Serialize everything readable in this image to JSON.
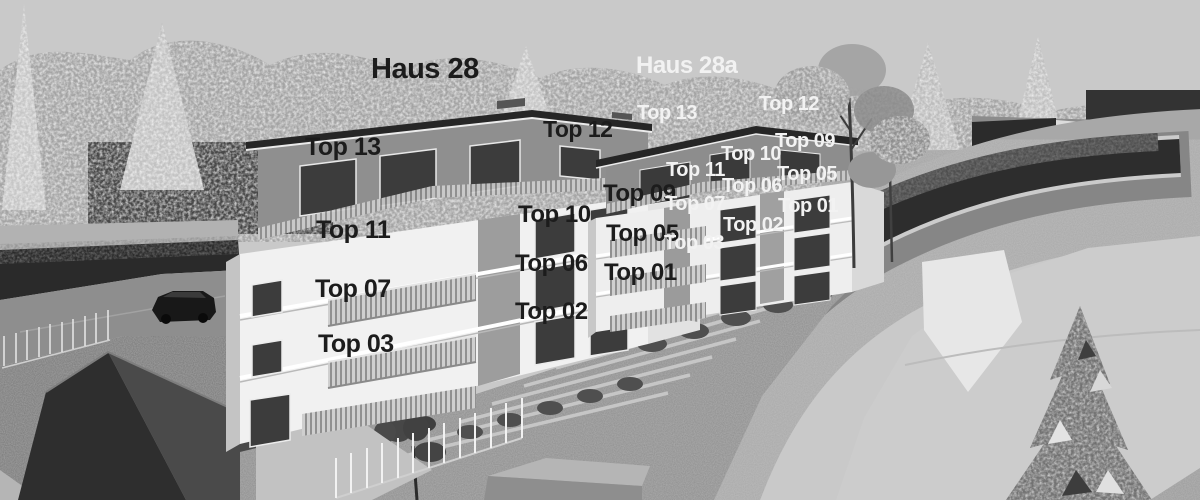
{
  "scene": {
    "kind": "architectural-rendering",
    "style": "grayscale 3D exterior visualization of two apartment buildings on a terraced slope with a curving road",
    "buildings": [
      {
        "id": "haus-28",
        "title": "Haus 28",
        "visible_units": [
          "Top 13",
          "Top 12",
          "Top 11",
          "Top 10",
          "Top 09",
          "Top 07",
          "Top 06",
          "Top 05",
          "Top 03",
          "Top 02",
          "Top 01"
        ]
      },
      {
        "id": "haus-28a",
        "title": "Haus 28a",
        "visible_units": [
          "Top 13",
          "Top 12",
          "Top 11",
          "Top 10",
          "Top 09",
          "Top 07",
          "Top 06",
          "Top 05",
          "Top 03",
          "Top 02",
          "Top 01"
        ]
      }
    ]
  },
  "annotations": {
    "building_titles": [
      {
        "building": "haus-28",
        "text": "Haus 28",
        "x": 371,
        "y": 55,
        "size": 29,
        "tone": "dark"
      },
      {
        "building": "haus-28a",
        "text": "Haus 28a",
        "x": 636,
        "y": 54,
        "size": 24,
        "tone": "light"
      }
    ],
    "unit_labels": [
      {
        "building": "haus-28",
        "text": "Top 13",
        "x": 305,
        "y": 135,
        "size": 25,
        "tone": "dark"
      },
      {
        "building": "haus-28",
        "text": "Top 12",
        "x": 543,
        "y": 118,
        "size": 23,
        "tone": "dark"
      },
      {
        "building": "haus-28",
        "text": "Top 11",
        "x": 316,
        "y": 218,
        "size": 25,
        "tone": "dark"
      },
      {
        "building": "haus-28",
        "text": "Top 10",
        "x": 518,
        "y": 203,
        "size": 24,
        "tone": "dark"
      },
      {
        "building": "haus-28",
        "text": "Top 09",
        "x": 603,
        "y": 182,
        "size": 24,
        "tone": "dark"
      },
      {
        "building": "haus-28",
        "text": "Top 07",
        "x": 315,
        "y": 277,
        "size": 25,
        "tone": "dark"
      },
      {
        "building": "haus-28",
        "text": "Top 06",
        "x": 515,
        "y": 252,
        "size": 24,
        "tone": "dark"
      },
      {
        "building": "haus-28",
        "text": "Top 05",
        "x": 606,
        "y": 222,
        "size": 24,
        "tone": "dark"
      },
      {
        "building": "haus-28",
        "text": "Top 03",
        "x": 318,
        "y": 332,
        "size": 25,
        "tone": "dark"
      },
      {
        "building": "haus-28",
        "text": "Top 02",
        "x": 515,
        "y": 300,
        "size": 24,
        "tone": "dark"
      },
      {
        "building": "haus-28",
        "text": "Top 01",
        "x": 604,
        "y": 261,
        "size": 24,
        "tone": "dark"
      },
      {
        "building": "haus-28a",
        "text": "Top 13",
        "x": 637,
        "y": 103,
        "size": 20,
        "tone": "light"
      },
      {
        "building": "haus-28a",
        "text": "Top 12",
        "x": 759,
        "y": 94,
        "size": 20,
        "tone": "light"
      },
      {
        "building": "haus-28a",
        "text": "Top 10",
        "x": 721,
        "y": 144,
        "size": 20,
        "tone": "light"
      },
      {
        "building": "haus-28a",
        "text": "Top 09",
        "x": 775,
        "y": 131,
        "size": 20,
        "tone": "light"
      },
      {
        "building": "haus-28a",
        "text": "Top 11",
        "x": 666,
        "y": 160,
        "size": 20,
        "tone": "light"
      },
      {
        "building": "haus-28a",
        "text": "Top 06",
        "x": 722,
        "y": 176,
        "size": 20,
        "tone": "light"
      },
      {
        "building": "haus-28a",
        "text": "Top 05",
        "x": 777,
        "y": 164,
        "size": 20,
        "tone": "light"
      },
      {
        "building": "haus-28a",
        "text": "Top 07",
        "x": 665,
        "y": 194,
        "size": 20,
        "tone": "light"
      },
      {
        "building": "haus-28a",
        "text": "Top 01",
        "x": 778,
        "y": 196,
        "size": 20,
        "tone": "light"
      },
      {
        "building": "haus-28a",
        "text": "Top 02",
        "x": 723,
        "y": 215,
        "size": 20,
        "tone": "light"
      },
      {
        "building": "haus-28a",
        "text": "Top 03",
        "x": 664,
        "y": 233,
        "size": 20,
        "tone": "light"
      }
    ]
  },
  "palette": {
    "sky": "#c9c9c9",
    "label_dark": "#1c1c1c",
    "label_light": "#f2f2f2",
    "facade_white": "#f1f1f1",
    "penthouse_gray": "#8f8f8f",
    "roof_dark": "#262626",
    "asphalt": "#2d2d2d",
    "plaza_light": "#cccccc"
  }
}
